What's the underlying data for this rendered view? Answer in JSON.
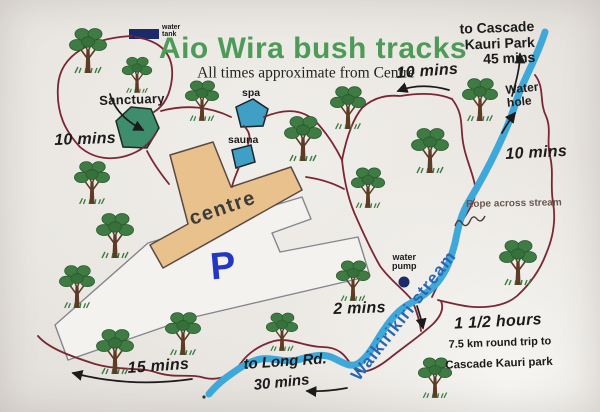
{
  "map": {
    "title": "Aio Wira bush tracks",
    "subtitle": "All times approximate from Centre",
    "colors": {
      "paper": "#eae7e2",
      "green": "#4e9a58",
      "track": "#7a2733",
      "stream": "#3fa8da",
      "streamtext": "#2a66b0",
      "tan": "#e9c18d",
      "sanct": "#3e8e6e",
      "teal": "#3f9fc4",
      "navy": "#1c2a6a",
      "pblue": "#2336c4",
      "ink": "#1b1b1b"
    },
    "labels": [
      {
        "id": "water-tank-label",
        "text": "water\ntank",
        "x": 162,
        "y": 24,
        "cls": "tiny"
      },
      {
        "id": "sanctuary-label",
        "text": "Sanctuary",
        "x": 99,
        "y": 94,
        "cls": "place",
        "rot": -2
      },
      {
        "id": "spa-label",
        "text": "spa",
        "x": 242,
        "y": 88,
        "cls": "small-place"
      },
      {
        "id": "sauna-label",
        "text": "sauna",
        "x": 228,
        "y": 135,
        "cls": "small-place"
      },
      {
        "id": "centre-label",
        "text": "centre",
        "x": 223,
        "y": 209,
        "cls": "centreTxt",
        "rot": -19,
        "centered": true
      },
      {
        "id": "parking-p-label",
        "text": "P",
        "x": 223,
        "y": 267,
        "cls": "pmark",
        "rot": -5,
        "centered": true
      },
      {
        "id": "ten-mins-west-label",
        "text": "10 mins",
        "x": 54,
        "y": 132,
        "cls": "time",
        "rot": -2
      },
      {
        "id": "ten-mins-top-label",
        "text": "10 mins",
        "x": 396,
        "y": 65,
        "cls": "time",
        "rot": -4
      },
      {
        "id": "cascade-dest-label",
        "text": "to Cascade\nKauri Park\n45 mins",
        "x": 448,
        "y": 22,
        "cls": "cascade",
        "rot": -2,
        "w": 86
      },
      {
        "id": "water-hole-label",
        "text": "Water\nhole",
        "x": 505,
        "y": 84,
        "cls": "hole",
        "rot": -6
      },
      {
        "id": "ten-mins-east-label",
        "text": "10 mins",
        "x": 505,
        "y": 146,
        "cls": "time",
        "rot": -3
      },
      {
        "id": "rope-label",
        "text": "Rope across stream",
        "x": 466,
        "y": 200,
        "cls": "note",
        "rot": -1
      },
      {
        "id": "water-pump-label",
        "text": "water\npump",
        "x": 392,
        "y": 253,
        "cls": "pump"
      },
      {
        "id": "two-mins-label",
        "text": "2 mins",
        "x": 333,
        "y": 301,
        "cls": "time",
        "rot": -2
      },
      {
        "id": "stream-name-label",
        "text": "Waikirikiri stream",
        "x": 404,
        "y": 316,
        "cls": "streamTxt",
        "rot": -52,
        "centered": true
      },
      {
        "id": "hours-label",
        "text": "1 1/2 hours",
        "x": 498,
        "y": 322,
        "cls": "time",
        "rot": -3,
        "centered": true
      },
      {
        "id": "roundtrip-label",
        "text": "7.5 km round trip to",
        "x": 500,
        "y": 344,
        "cls": "subnote",
        "rot": -2,
        "centered": true
      },
      {
        "id": "cascade-park-label",
        "text": "Cascade Kauri park",
        "x": 499,
        "y": 364,
        "cls": "subnote2",
        "rot": -2,
        "centered": true
      },
      {
        "id": "fifteen-mins-label",
        "text": "15 mins",
        "x": 127,
        "y": 360,
        "cls": "time",
        "rot": -4
      },
      {
        "id": "long-rd-label",
        "text": "to Long Rd.",
        "x": 243,
        "y": 357,
        "cls": "time2",
        "rot": -4
      },
      {
        "id": "thirty-mins-label",
        "text": "30 mins",
        "x": 253,
        "y": 378,
        "cls": "time2",
        "rot": -6
      }
    ],
    "trees": [
      {
        "x": 88,
        "y": 72,
        "s": 1
      },
      {
        "x": 137,
        "y": 92,
        "s": 0.8
      },
      {
        "x": 202,
        "y": 120,
        "s": 0.9
      },
      {
        "x": 92,
        "y": 203,
        "s": 0.95
      },
      {
        "x": 303,
        "y": 160,
        "s": 1
      },
      {
        "x": 348,
        "y": 128,
        "s": 0.95
      },
      {
        "x": 430,
        "y": 172,
        "s": 1
      },
      {
        "x": 480,
        "y": 120,
        "s": 0.95
      },
      {
        "x": 368,
        "y": 207,
        "s": 0.9
      },
      {
        "x": 518,
        "y": 284,
        "s": 1
      },
      {
        "x": 353,
        "y": 300,
        "s": 0.9
      },
      {
        "x": 115,
        "y": 257,
        "s": 1
      },
      {
        "x": 77,
        "y": 307,
        "s": 0.95
      },
      {
        "x": 115,
        "y": 373,
        "s": 1
      },
      {
        "x": 183,
        "y": 354,
        "s": 0.95
      },
      {
        "x": 282,
        "y": 350,
        "s": 0.85
      },
      {
        "x": 435,
        "y": 397,
        "s": 0.9
      }
    ]
  }
}
